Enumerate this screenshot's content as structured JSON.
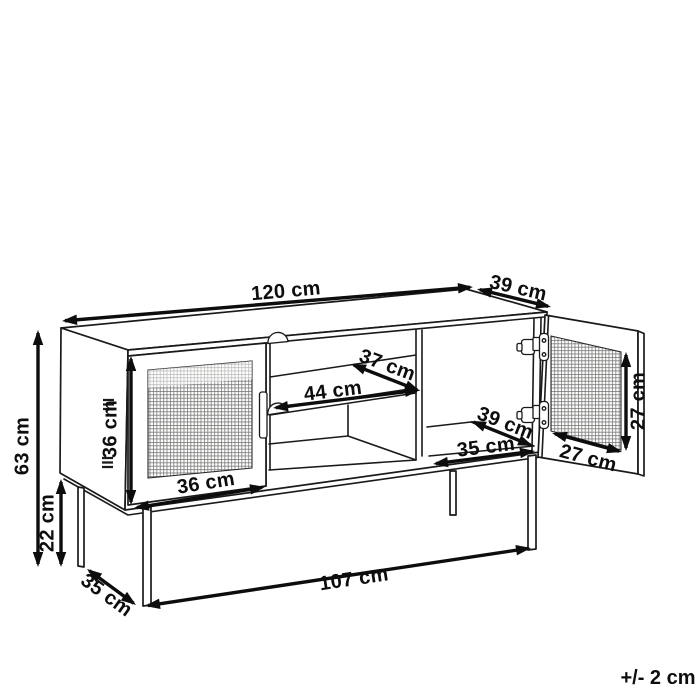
{
  "figure": {
    "kind": "furniture-dimension-diagram",
    "subject": "sideboard with two rattan mesh doors, open middle shelf and metal legs",
    "unit": "cm"
  },
  "note": {
    "text": "+/- 2 cm",
    "x": 658,
    "y": 684
  },
  "dimensions": [
    {
      "id": "top-width",
      "label": "120 cm",
      "value": 120,
      "part": "overall width (top edge)",
      "x1": 62,
      "y1": 321,
      "x2": 473,
      "y2": 287,
      "lx": 286,
      "ly": 292,
      "rot": -5
    },
    {
      "id": "top-depth",
      "label": "39 cm",
      "value": 39,
      "part": "overall depth (top edge)",
      "x1": 477,
      "y1": 289,
      "x2": 551,
      "y2": 307,
      "lx": 518,
      "ly": 289,
      "rot": 13
    },
    {
      "id": "total-height",
      "label": "63 cm",
      "value": 63,
      "part": "overall height",
      "x1": 38,
      "y1": 330,
      "x2": 38,
      "y2": 567,
      "lx": 23,
      "ly": 446,
      "rot": -90
    },
    {
      "id": "leg-height",
      "label": "22 cm",
      "value": 22,
      "part": "leg height",
      "x1": 61,
      "y1": 479,
      "x2": 61,
      "y2": 567,
      "lx": 48,
      "ly": 523,
      "rot": -90
    },
    {
      "id": "door-height",
      "label": "36 cm",
      "value": 36,
      "part": "left door height",
      "x1": 131,
      "y1": 356,
      "x2": 131,
      "y2": 505,
      "lx": 111,
      "ly": 429,
      "rot": -90
    },
    {
      "id": "door-width",
      "label": "36 cm",
      "value": 36,
      "part": "left door width",
      "x1": 134,
      "y1": 508,
      "x2": 265,
      "y2": 487,
      "lx": 206,
      "ly": 484,
      "rot": -9
    },
    {
      "id": "shelf-width",
      "label": "44 cm",
      "value": 44,
      "part": "middle shelf width",
      "x1": 273,
      "y1": 408,
      "x2": 420,
      "y2": 390,
      "lx": 333,
      "ly": 392,
      "rot": -7
    },
    {
      "id": "shelf-depth",
      "label": "37 cm",
      "value": 37,
      "part": "middle shelf depth",
      "x1": 351,
      "y1": 364,
      "x2": 420,
      "y2": 391,
      "lx": 387,
      "ly": 366,
      "rot": 20
    },
    {
      "id": "right-depth",
      "label": "39 cm",
      "value": 39,
      "part": "right compartment depth",
      "x1": 471,
      "y1": 421,
      "x2": 533,
      "y2": 446,
      "lx": 505,
      "ly": 424,
      "rot": 21
    },
    {
      "id": "right-width",
      "label": "35 cm",
      "value": 35,
      "part": "right compartment width",
      "x1": 433,
      "y1": 464,
      "x2": 535,
      "y2": 451,
      "lx": 486,
      "ly": 448,
      "rot": -7
    },
    {
      "id": "right-door-height",
      "label": "27 cm",
      "value": 27,
      "part": "right door mesh height",
      "x1": 626,
      "y1": 352,
      "x2": 626,
      "y2": 451,
      "lx": 639,
      "ly": 401,
      "rot": -90
    },
    {
      "id": "right-door-width",
      "label": "27 cm",
      "value": 27,
      "part": "right door mesh width",
      "x1": 552,
      "y1": 433,
      "x2": 622,
      "y2": 452,
      "lx": 588,
      "ly": 459,
      "rot": 15
    },
    {
      "id": "base-depth",
      "label": "35 cm",
      "value": 35,
      "part": "base frame depth",
      "x1": 87,
      "y1": 569,
      "x2": 136,
      "y2": 605,
      "lx": 106,
      "ly": 596,
      "rot": 36
    },
    {
      "id": "base-width",
      "label": "107 cm",
      "value": 107,
      "part": "base frame width",
      "x1": 145,
      "y1": 606,
      "x2": 531,
      "y2": 548,
      "lx": 354,
      "ly": 580,
      "rot": -8.5
    }
  ]
}
